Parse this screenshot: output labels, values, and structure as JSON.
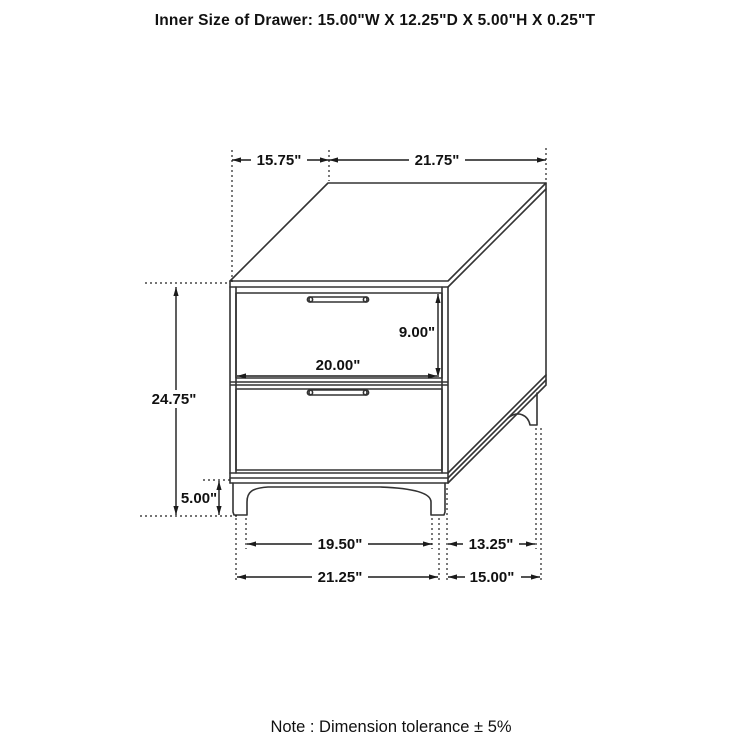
{
  "title": "Inner Size of Drawer: 15.00\"W X 12.25\"D X 5.00\"H X 0.25\"T",
  "note": "Note : Dimension tolerance  ± 5%",
  "dimensions": {
    "top_depth": "15.75\"",
    "top_width": "21.75\"",
    "overall_height": "24.75\"",
    "drawer_opening_height": "9.00\"",
    "drawer_front_width": "20.00\"",
    "leg_height": "5.00\"",
    "front_leg_span": "19.50\"",
    "side_leg_span": "13.25\"",
    "base_front_width": "21.25\"",
    "base_side_depth": "15.00\""
  },
  "colors": {
    "line": "#333333",
    "dimension": "#1b1b1b",
    "background": "#ffffff"
  }
}
